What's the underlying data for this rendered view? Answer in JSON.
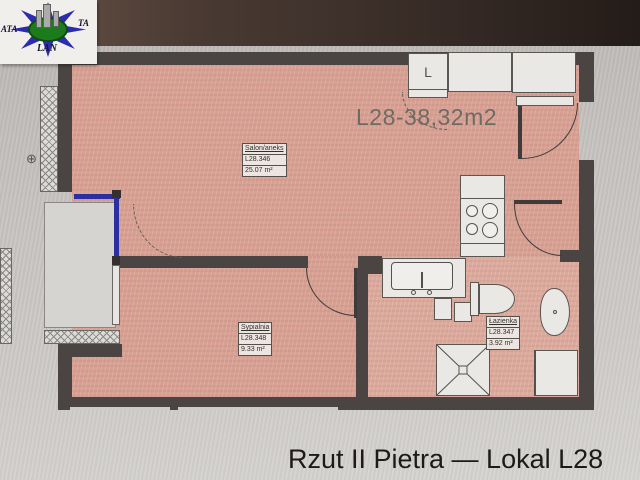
{
  "logo": {
    "left": "ATA",
    "right": "TA",
    "bottom": "LAN"
  },
  "plan": {
    "title": "L28-38,32m2",
    "closet_label": "L",
    "rooms": [
      {
        "name": "Salon/aneks",
        "code": "L28.346",
        "area": "25.07 m²"
      },
      {
        "name": "Sypialnia",
        "code": "L28.348",
        "area": "9.33 m²"
      },
      {
        "name": "Łazienka",
        "code": "L28.347",
        "area": "3.92 m²"
      }
    ]
  },
  "caption": "Rzut II Pietra — Lokal L28",
  "colors": {
    "wall": "#4a4542",
    "room_fill": "#d7a093",
    "window_blue": "#2b2fa0",
    "logo_blue": "#2c2cae",
    "logo_green": "#1c7c1c",
    "paper": "#c7c4c1"
  }
}
